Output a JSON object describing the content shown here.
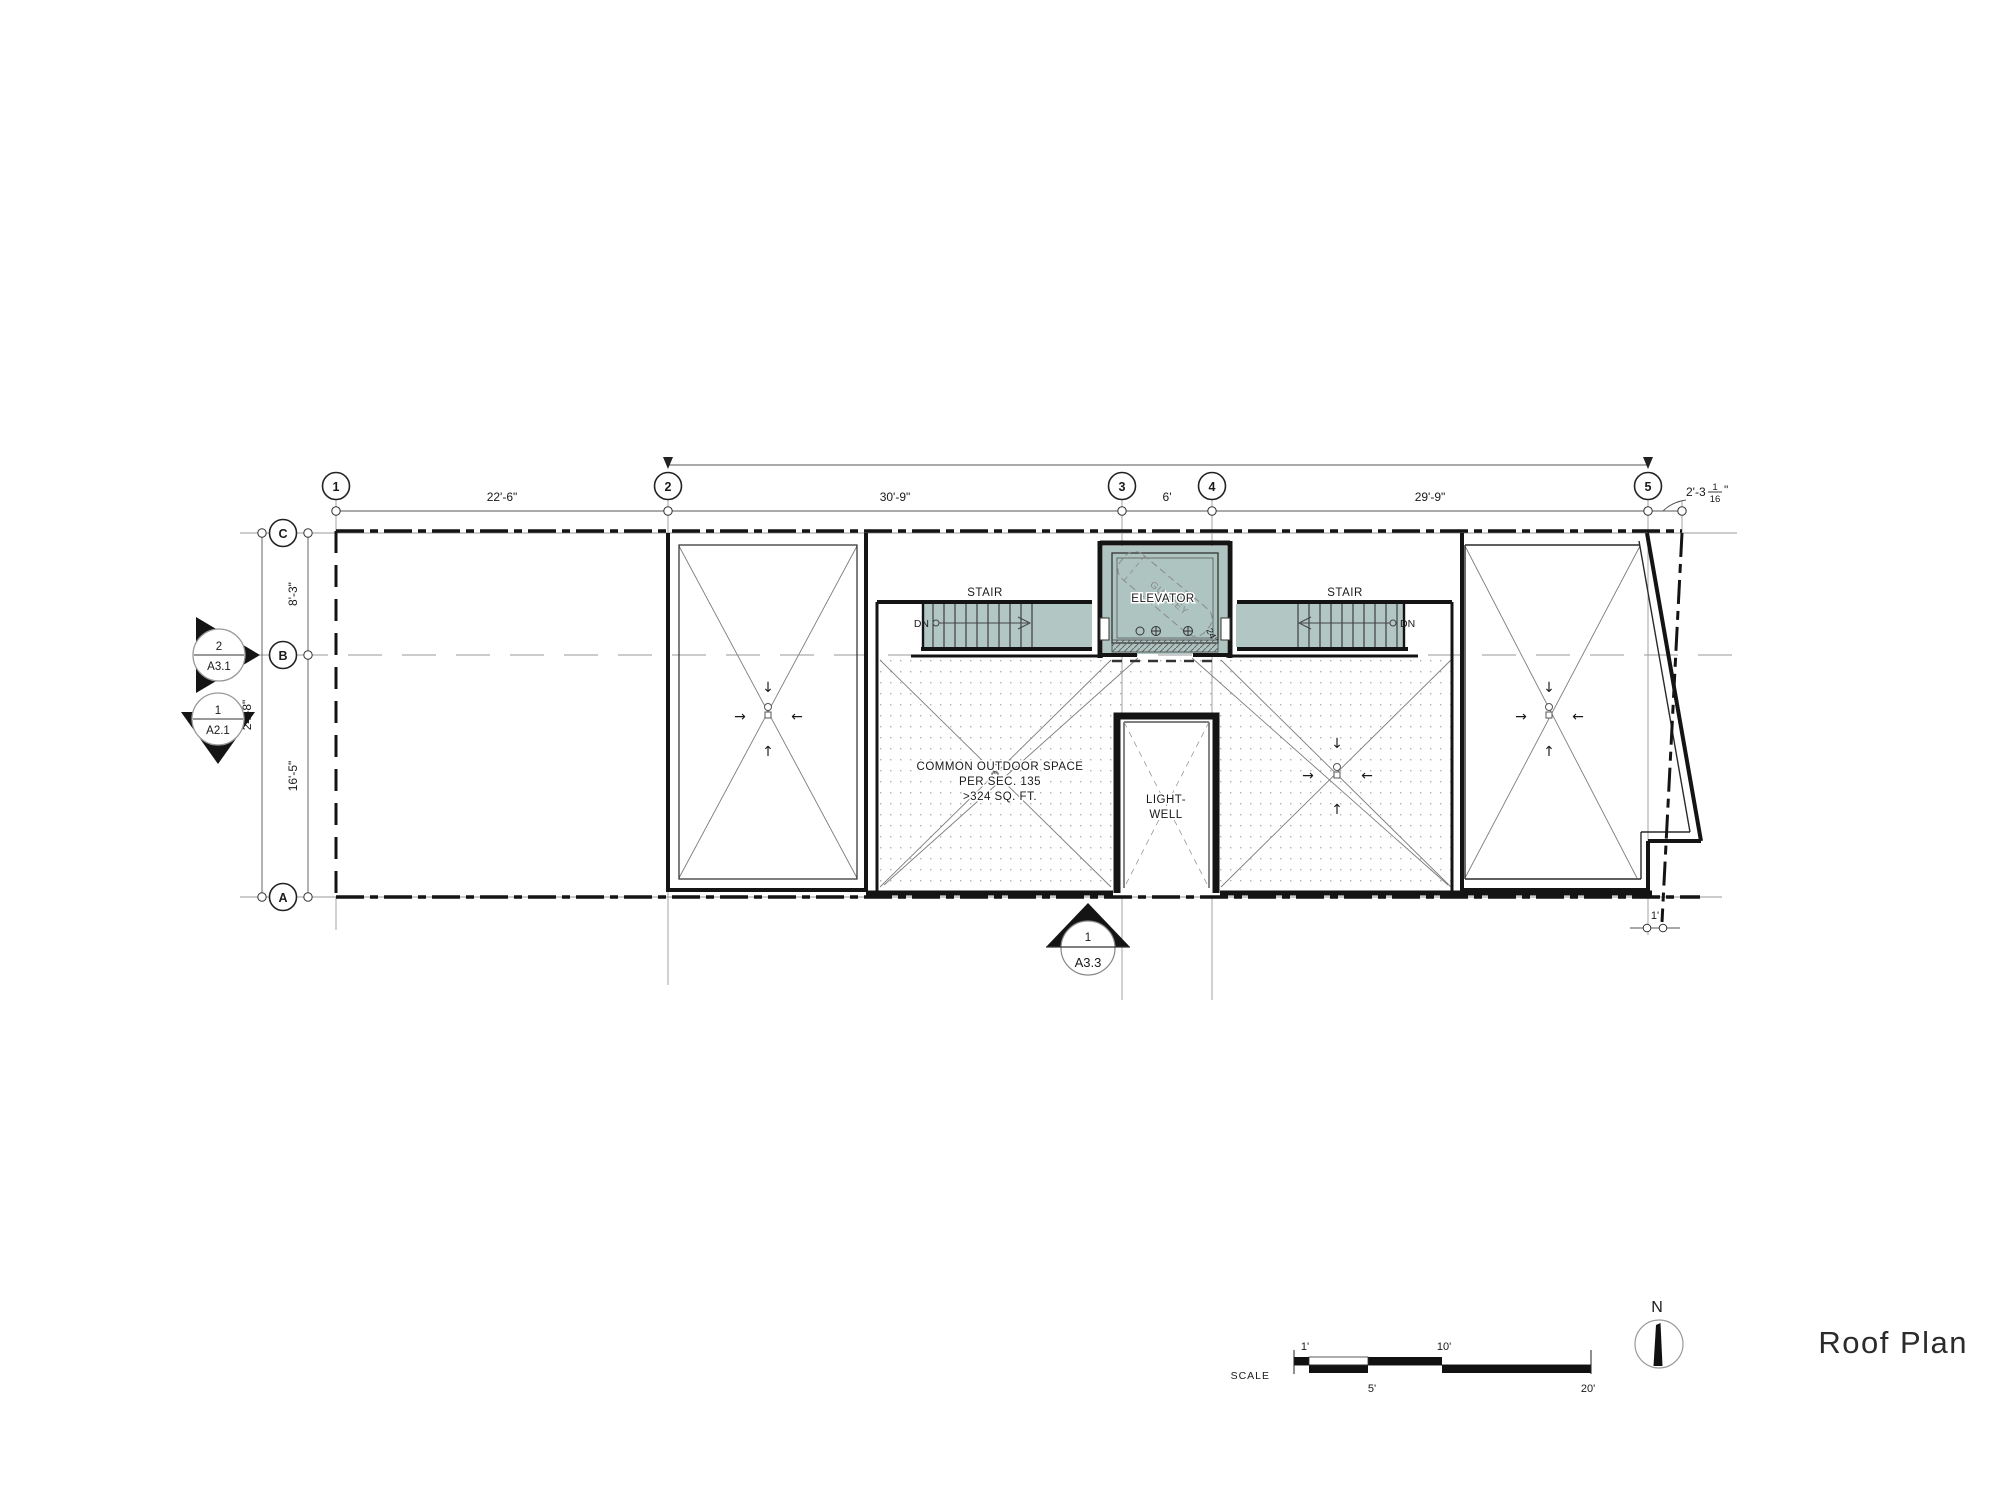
{
  "drawing_title": "Roof Plan",
  "grid": {
    "cols": [
      "1",
      "2",
      "3",
      "4",
      "5"
    ],
    "rows": [
      "C",
      "B",
      "A"
    ]
  },
  "dimensions": {
    "top": [
      "22'-6\"",
      "30'-9\"",
      "6'",
      "29'-9\""
    ],
    "top_right": {
      "whole": "2'-3",
      "numerator": "1",
      "denominator": "16",
      "unit": "\""
    },
    "left": {
      "c_to_b": "8'-3\"",
      "b_to_a": "16'-5\"",
      "overall": "24'-8\""
    },
    "bottom_right": "1'"
  },
  "rooms": {
    "stair_left": "STAIR",
    "stair_right": "STAIR",
    "elevator": "ELEVATOR",
    "gurney": "GURNEY",
    "gurney_width": "24\"",
    "down_left": "DN",
    "down_right": "DN",
    "common_space": [
      "COMMON OUTDOOR SPACE",
      "PER SEC. 135",
      ">324 SQ. FT."
    ],
    "light_well": [
      "LIGHT-",
      "WELL"
    ]
  },
  "section_markers": {
    "right_facing": {
      "number": "2",
      "sheet": "A3.1"
    },
    "down_facing": {
      "number": "1",
      "sheet": "A2.1"
    },
    "up_facing": {
      "number": "1",
      "sheet": "A3.3"
    }
  },
  "scale_bar": {
    "label": "SCALE",
    "tick_1": "1'",
    "tick_5": "5'",
    "tick_10": "10'",
    "tick_20": "20'"
  },
  "north_arrow": {
    "label": "N"
  },
  "colors": {
    "wall": "#141414",
    "thin_line": "#8f8f8f",
    "teal_fill": "#b2c6c3",
    "stipple_dot": "#b3b3b3",
    "text": "#1a1a1a"
  }
}
